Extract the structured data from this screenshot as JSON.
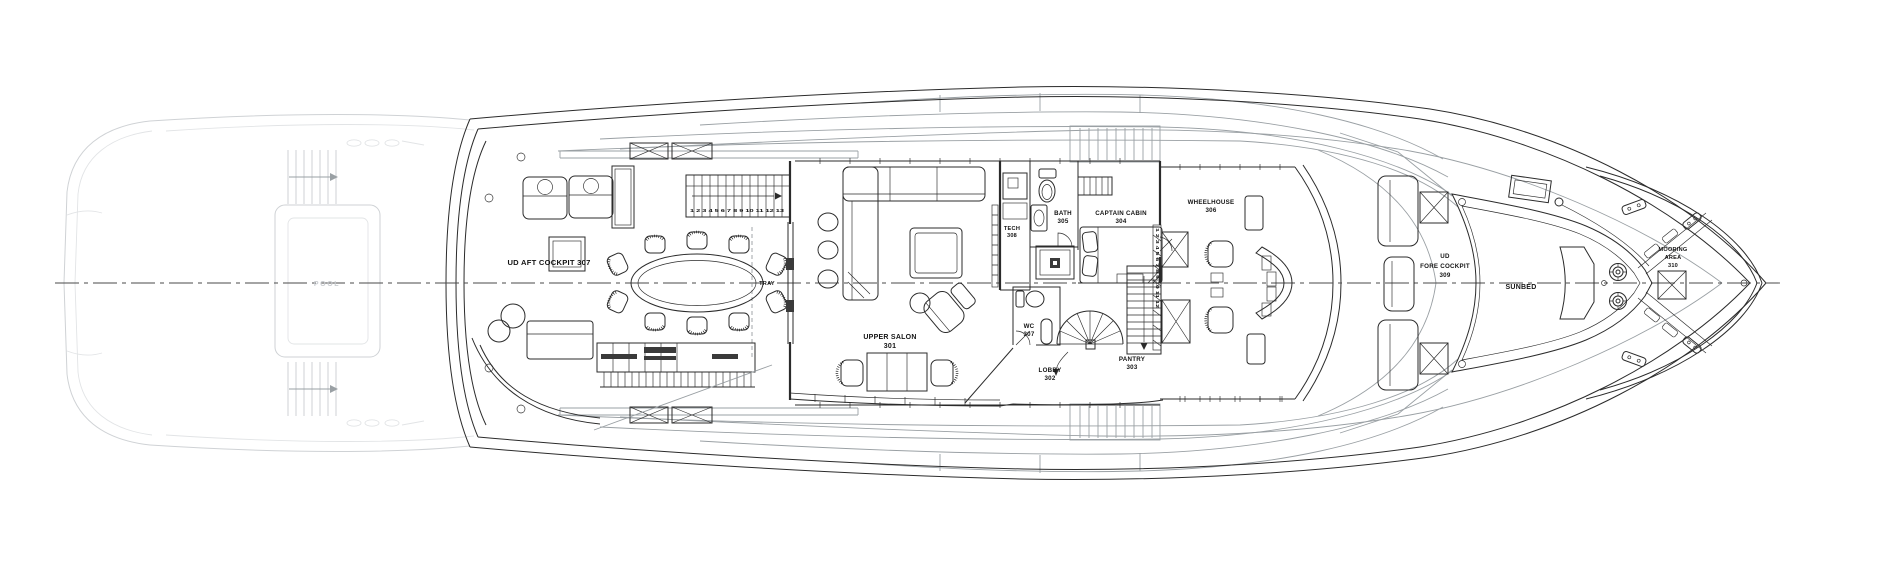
{
  "deck_plan": {
    "labels": {
      "ud_aft_cockpit": [
        "UD AFT COCKPIT 307"
      ],
      "tray": [
        "TRAY"
      ],
      "upper_salon": [
        "UPPER SALON",
        "301"
      ],
      "tech": [
        "TECH",
        "308"
      ],
      "bath": [
        "BATH",
        "305"
      ],
      "captain_cabin": [
        "CAPTAIN CABIN",
        "304"
      ],
      "wheelhouse": [
        "WHEELHOUSE",
        "306"
      ],
      "wc": [
        "WC",
        "307"
      ],
      "lobby": [
        "LOBBY",
        "302"
      ],
      "pantry": [
        "PANTRY",
        "303"
      ],
      "ud_fore_cockpit": [
        "UD",
        "FORE COCKPIT",
        "309"
      ],
      "sunbed": [
        "SUNBED"
      ],
      "mooring_area": [
        "MOORING",
        "AREA",
        "310"
      ],
      "pool_faint": [
        "POOL"
      ]
    },
    "stairs": {
      "aft_numbers": "1 2 3 4 5 6 7 8 9 10 11 12 13",
      "pantry_numbers": "1 2 3 4 5 6 7 8 9 10 11 12"
    },
    "colors": {
      "background": "#ffffff",
      "ink": "#2b2b2b",
      "mid_gray": "#9aa0a4",
      "faint_gray": "#cfd2d5"
    }
  }
}
